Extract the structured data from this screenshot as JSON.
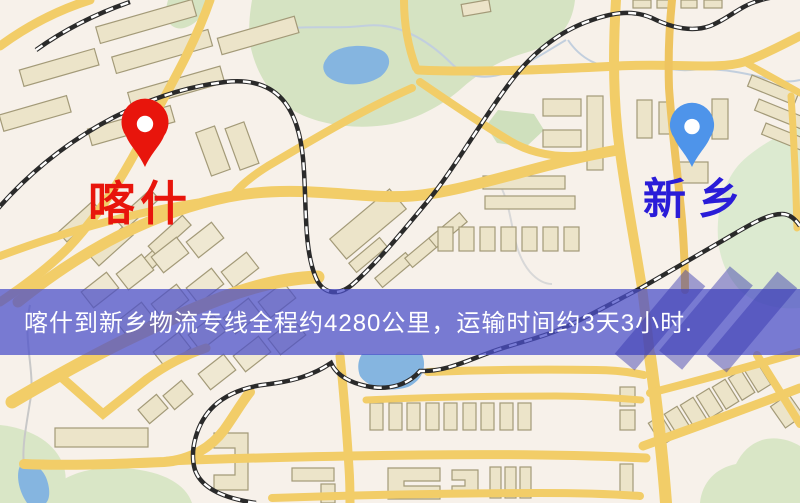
{
  "markers": {
    "origin": {
      "label": "喀什",
      "pin": "red-location-pin-icon",
      "pin_color": "#e8150c",
      "label_color": "#e8150c"
    },
    "destination": {
      "label": "新乡",
      "pin": "blue-location-pin-icon",
      "pin_color": "#4e94ea",
      "label_color": "#2a1cd8"
    }
  },
  "banner": {
    "text": "喀什到新乡物流专线全程约4280公里，运输时间约3天3小时.",
    "bg_color": "#4b4fc9",
    "text_color": "#ffffff"
  },
  "map_palette": {
    "background": "#f7f1ea",
    "road": "#f2cd68",
    "park": "#d5e3c2",
    "water": "#85b5e0",
    "railway": "#222222",
    "building": "#ece4c9"
  }
}
